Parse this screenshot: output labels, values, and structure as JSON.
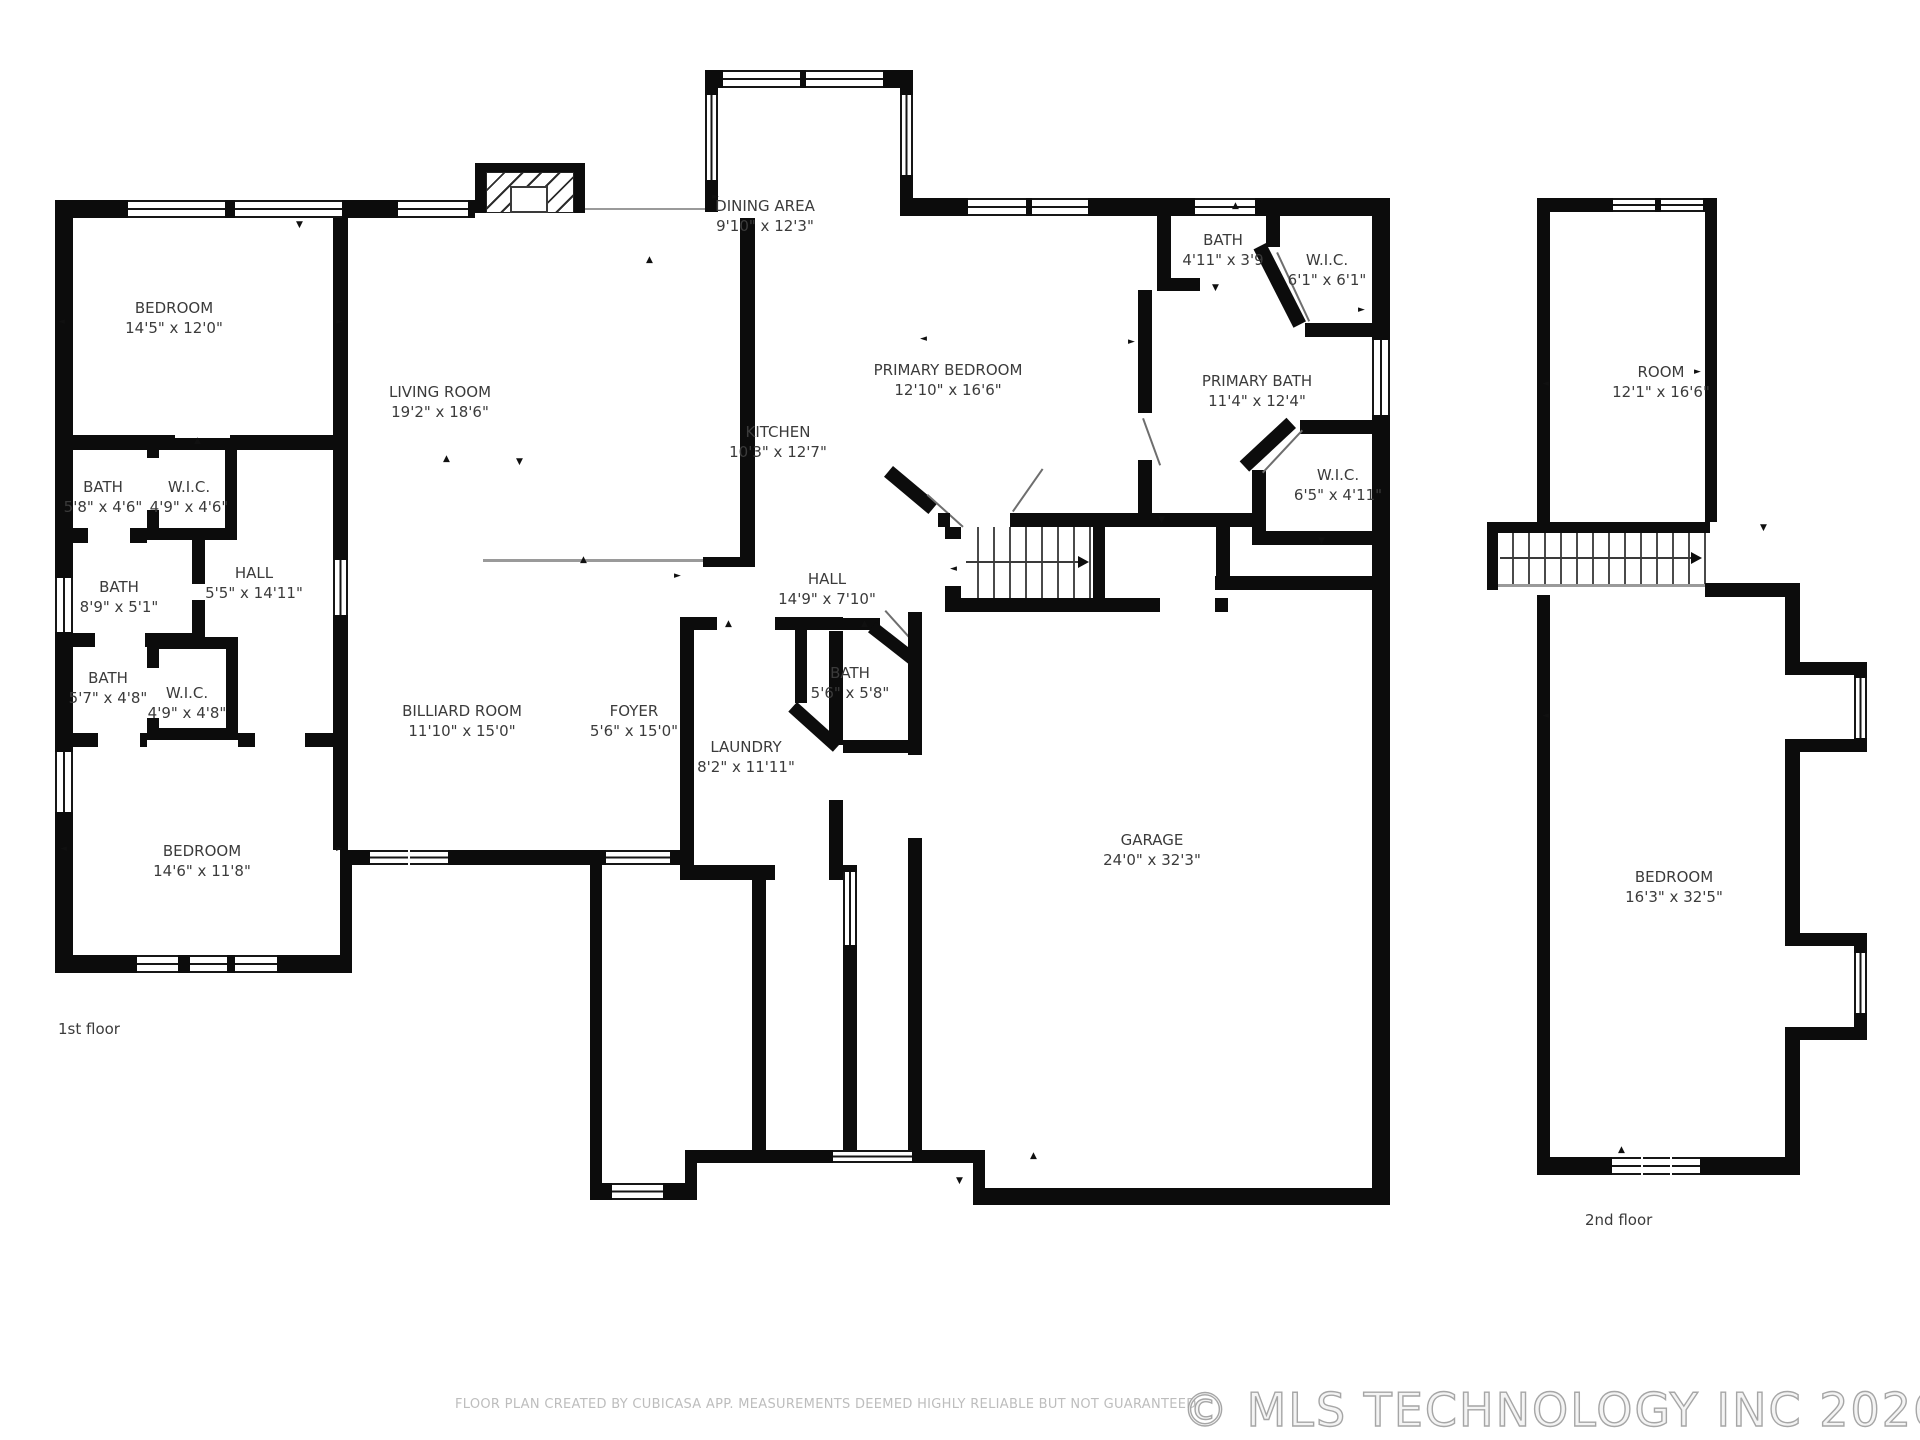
{
  "floor_labels": {
    "first": "1st floor",
    "second": "2nd floor"
  },
  "footer": {
    "disclaimer": "FLOOR PLAN CREATED BY CUBICASA APP. MEASUREMENTS DEEMED HIGHLY RELIABLE BUT NOT GUARANTEED",
    "copyright": "© MLS TECHNOLOGY INC 2026"
  },
  "colors": {
    "wall": "#0c0c0c",
    "label_text": "#3b3b3b",
    "muted_text": "#bdbdbd"
  },
  "rooms": {
    "bedroom_tl": {
      "name": "BEDROOM",
      "dims": "14'5\" x 12'0\""
    },
    "living": {
      "name": "LIVING ROOM",
      "dims": "19'2\" x 18'6\""
    },
    "dining": {
      "name": "DINING AREA",
      "dims": "9'10\" x 12'3\""
    },
    "kitchen": {
      "name": "KITCHEN",
      "dims": "10'3\" x 12'7\""
    },
    "primary_bedroom": {
      "name": "PRIMARY BEDROOM",
      "dims": "12'10\" x 16'6\""
    },
    "bath_tr": {
      "name": "BATH",
      "dims": "4'11\" x 3'9"
    },
    "wic_tr": {
      "name": "W.I.C.",
      "dims": "6'1\" x 6'1\""
    },
    "primary_bath": {
      "name": "PRIMARY BATH",
      "dims": "11'4\" x 12'4\""
    },
    "wic_mid": {
      "name": "W.I.C.",
      "dims": "6'5\" x 4'11\""
    },
    "hall_center": {
      "name": "HALL",
      "dims": "14'9\" x 7'10\""
    },
    "bath_tl": {
      "name": "BATH",
      "dims": "5'8\" x 4'6\""
    },
    "wic_tl": {
      "name": "W.I.C.",
      "dims": "4'9\" x 4'6\""
    },
    "bath_mid": {
      "name": "BATH",
      "dims": "8'9\" x 5'1\""
    },
    "hall_left": {
      "name": "HALL",
      "dims": "5'5\" x 14'11\""
    },
    "bath_bl": {
      "name": "BATH",
      "dims": "5'7\" x 4'8\""
    },
    "wic_bl": {
      "name": "W.I.C.",
      "dims": "4'9\" x 4'8\""
    },
    "bedroom_bl": {
      "name": "BEDROOM",
      "dims": "14'6\" x 11'8\""
    },
    "billiard": {
      "name": "BILLIARD ROOM",
      "dims": "11'10\" x 15'0\""
    },
    "foyer": {
      "name": "FOYER",
      "dims": "5'6\" x 15'0\""
    },
    "laundry": {
      "name": "LAUNDRY",
      "dims": "8'2\" x 11'11\""
    },
    "bath_center": {
      "name": "BATH",
      "dims": "5'6\" x 5'8\""
    },
    "garage": {
      "name": "GARAGE",
      "dims": "24'0\" x 32'3\""
    },
    "room2": {
      "name": "ROOM",
      "dims": "12'1\" x 16'6\""
    },
    "bedroom2": {
      "name": "BEDROOM",
      "dims": "16'3\" x 32'5\""
    }
  }
}
